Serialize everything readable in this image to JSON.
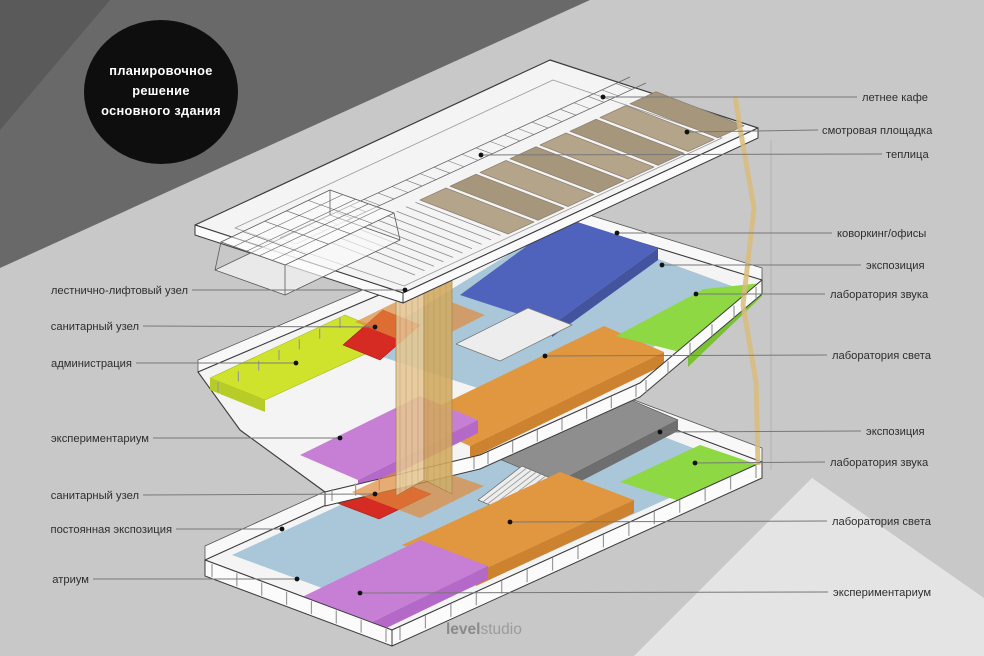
{
  "badge": {
    "line1": "планировочное",
    "line2": "решение",
    "line3": "основного здания"
  },
  "labels": {
    "left": [
      {
        "text": "лестнично-лифтовый узел"
      },
      {
        "text": "санитарный узел"
      },
      {
        "text": "администрация"
      },
      {
        "text": "экспериментариум"
      },
      {
        "text": "санитарный узел"
      },
      {
        "text": "постоянная экспозиция"
      },
      {
        "text": "атриум"
      }
    ],
    "right": [
      {
        "text": "летнее кафе"
      },
      {
        "text": "смотровая площадка"
      },
      {
        "text": "теплица"
      },
      {
        "text": "коворкинг/офисы"
      },
      {
        "text": "экспозиция"
      },
      {
        "text": "лаборатория звука"
      },
      {
        "text": "лаборатория света"
      },
      {
        "text": "экспозиция"
      },
      {
        "text": "лаборатория звука"
      },
      {
        "text": "лаборатория света"
      },
      {
        "text": "экспериментариум"
      }
    ]
  },
  "logo": {
    "bold": "level",
    "light": "studio"
  },
  "colors": {
    "bg": "#c8c8c8",
    "band": "#696969",
    "band_corner": "#5a5a5a",
    "circle": "#0e0e0e",
    "badge_text": "#ffffff",
    "triangle": "#e4e4e4",
    "slab": "#f4f4f4",
    "slab_side": "#fbfbfb",
    "wall_far": "#f8f8f8",
    "outline": "#3c3c3c",
    "floor_light_blue": "#a9c7d8",
    "zone_blue": "#4f63bd",
    "zone_blue_wall": "#44539e",
    "zone_lime": "#8ed843",
    "zone_lime_wall": "#7bc232",
    "zone_admin": "#cfe32d",
    "zone_admin_wall": "#b8cc28",
    "zone_orange": "#e1973f",
    "zone_orange_wall": "#cd8230",
    "zone_purple": "#c77fd6",
    "zone_purple_wall": "#b468c8",
    "zone_red": "#d62b22",
    "zone_gray": "#8e8e8e",
    "zone_gray_side": "#6e6e6e",
    "tower_light": "#e5c795",
    "tower_dark": "#d3aa60",
    "tower_stripe": "#b98f45",
    "landing": "#e08b3c",
    "roof_brown": "#b3a48a",
    "roof_brown_dark": "#a5967c",
    "pipe": "#d9bc7a",
    "stairs": "#ededed",
    "white_box": "#ededed",
    "label": "#2e2e2e",
    "line": "#787878",
    "dot": "#111111",
    "logo_bold": "#8a8a8a",
    "logo_light": "#9b9b9b"
  }
}
